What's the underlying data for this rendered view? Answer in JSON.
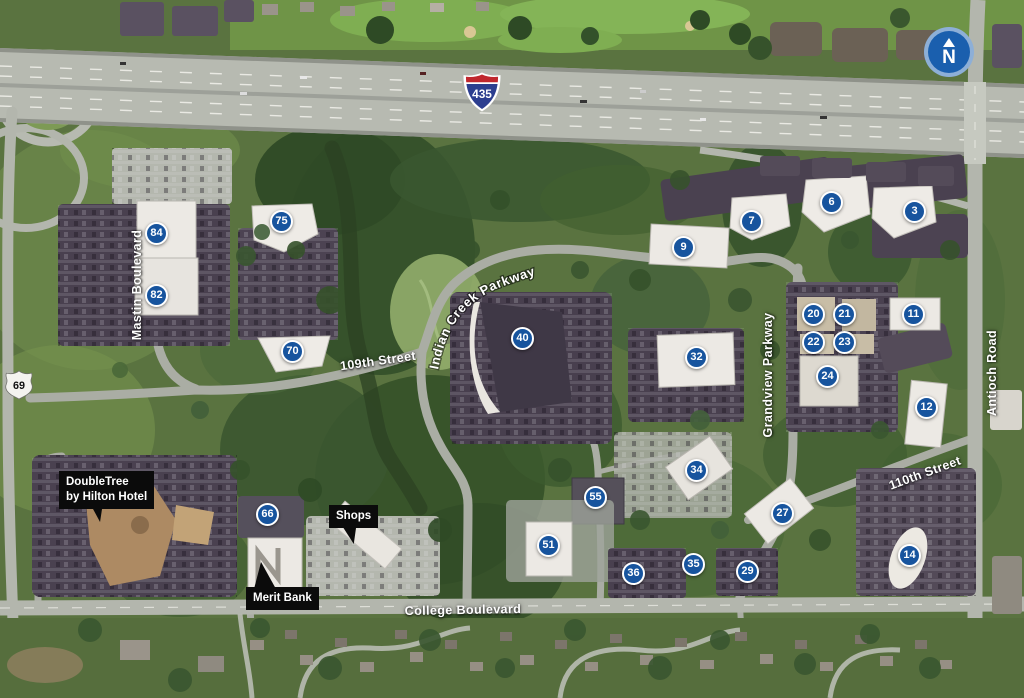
{
  "map": {
    "compass": {
      "label": "N"
    },
    "shields": [
      {
        "kind": "interstate-shield",
        "number": "435"
      },
      {
        "kind": "us-route-shield",
        "number": "69"
      }
    ],
    "markers": [
      {
        "n": "84",
        "x": 157,
        "y": 234
      },
      {
        "n": "82",
        "x": 157,
        "y": 296
      },
      {
        "n": "75",
        "x": 282,
        "y": 222
      },
      {
        "n": "70",
        "x": 293,
        "y": 352
      },
      {
        "n": "40",
        "x": 523,
        "y": 339
      },
      {
        "n": "9",
        "x": 684,
        "y": 248
      },
      {
        "n": "7",
        "x": 752,
        "y": 222
      },
      {
        "n": "6",
        "x": 832,
        "y": 203
      },
      {
        "n": "3",
        "x": 915,
        "y": 212
      },
      {
        "n": "32",
        "x": 697,
        "y": 358
      },
      {
        "n": "20",
        "x": 814,
        "y": 315
      },
      {
        "n": "21",
        "x": 845,
        "y": 315
      },
      {
        "n": "22",
        "x": 814,
        "y": 343
      },
      {
        "n": "23",
        "x": 845,
        "y": 343
      },
      {
        "n": "24",
        "x": 828,
        "y": 377
      },
      {
        "n": "11",
        "x": 914,
        "y": 315
      },
      {
        "n": "12",
        "x": 927,
        "y": 408
      },
      {
        "n": "34",
        "x": 697,
        "y": 471
      },
      {
        "n": "55",
        "x": 596,
        "y": 498
      },
      {
        "n": "51",
        "x": 549,
        "y": 546
      },
      {
        "n": "27",
        "x": 783,
        "y": 514
      },
      {
        "n": "14",
        "x": 910,
        "y": 556
      },
      {
        "n": "36",
        "x": 634,
        "y": 574
      },
      {
        "n": "35",
        "x": 694,
        "y": 565
      },
      {
        "n": "29",
        "x": 748,
        "y": 572
      },
      {
        "n": "66",
        "x": 268,
        "y": 515
      }
    ],
    "street_labels": [
      {
        "text": "Mastin Boulevard",
        "x": 137,
        "y": 285,
        "rot": -90
      },
      {
        "text": "109th Street",
        "x": 378,
        "y": 361,
        "rot": -8
      },
      {
        "text": "Indian Creek Parkway",
        "curved": true
      },
      {
        "text": "Grandview Parkway",
        "x": 768,
        "y": 375,
        "rot": -90
      },
      {
        "text": "Antioch Road",
        "x": 992,
        "y": 373,
        "rot": -90
      },
      {
        "text": "110th Street",
        "x": 925,
        "y": 473,
        "rot": -20
      },
      {
        "text": "College Boulevard",
        "x": 463,
        "y": 610,
        "rot": -1
      }
    ],
    "poi_labels": [
      {
        "lines": [
          "DoubleTree",
          "by Hilton Hotel"
        ],
        "x": 59,
        "y": 471
      },
      {
        "lines": [
          "Shops"
        ],
        "x": 329,
        "y": 505
      },
      {
        "lines": [
          "Merit Bank"
        ],
        "x": 246,
        "y": 587
      }
    ],
    "colors": {
      "marker_blue": "#17549e",
      "compass_blue": "#1a5fae",
      "interstate_red": "#c0272d",
      "interstate_blue": "#2c3e8f"
    }
  }
}
